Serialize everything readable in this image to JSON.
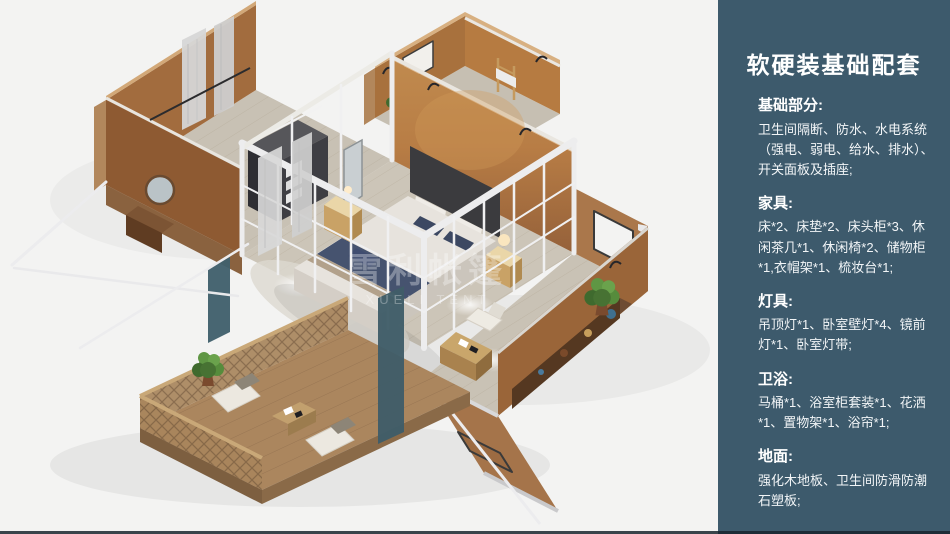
{
  "colors": {
    "panel_bg": "#f3f3f2",
    "sidebar_bg": "#3d5a6c",
    "sidebar_text": "#ffffff",
    "wall_tan": "#a97744",
    "wall_orange": "#b57a42",
    "floor_wood": "#ccc5b8",
    "deck_wood": "#ab865e",
    "bed_navy": "#46536f",
    "frame_white": "#ededee",
    "plant_green": "#4c7a38"
  },
  "render": {
    "watermark_cn": "雪利帐篷",
    "watermark_en": "XUELI TENT"
  },
  "sidebar": {
    "title": "软硬装基础配套",
    "sections": [
      {
        "heading": "基础部分:",
        "body": "卫生间隔断、防水、水电系统（强电、弱电、给水、排水）、开关面板及插座;"
      },
      {
        "heading": "家具:",
        "body": "床*2、床垫*2、床头柜*3、休闲茶几*1、休闲椅*2、储物柜*1,衣帽架*1、梳妆台*1;"
      },
      {
        "heading": "灯具:",
        "body": "吊顶灯*1、卧室壁灯*4、镜前灯*1、卧室灯带;"
      },
      {
        "heading": "卫浴:",
        "body": "马桶*1、浴室柜套装*1、花洒*1、置物架*1、浴帘*1;"
      },
      {
        "heading": "地面:",
        "body": "强化木地板、卫生间防滑防潮石塑板;"
      }
    ]
  }
}
